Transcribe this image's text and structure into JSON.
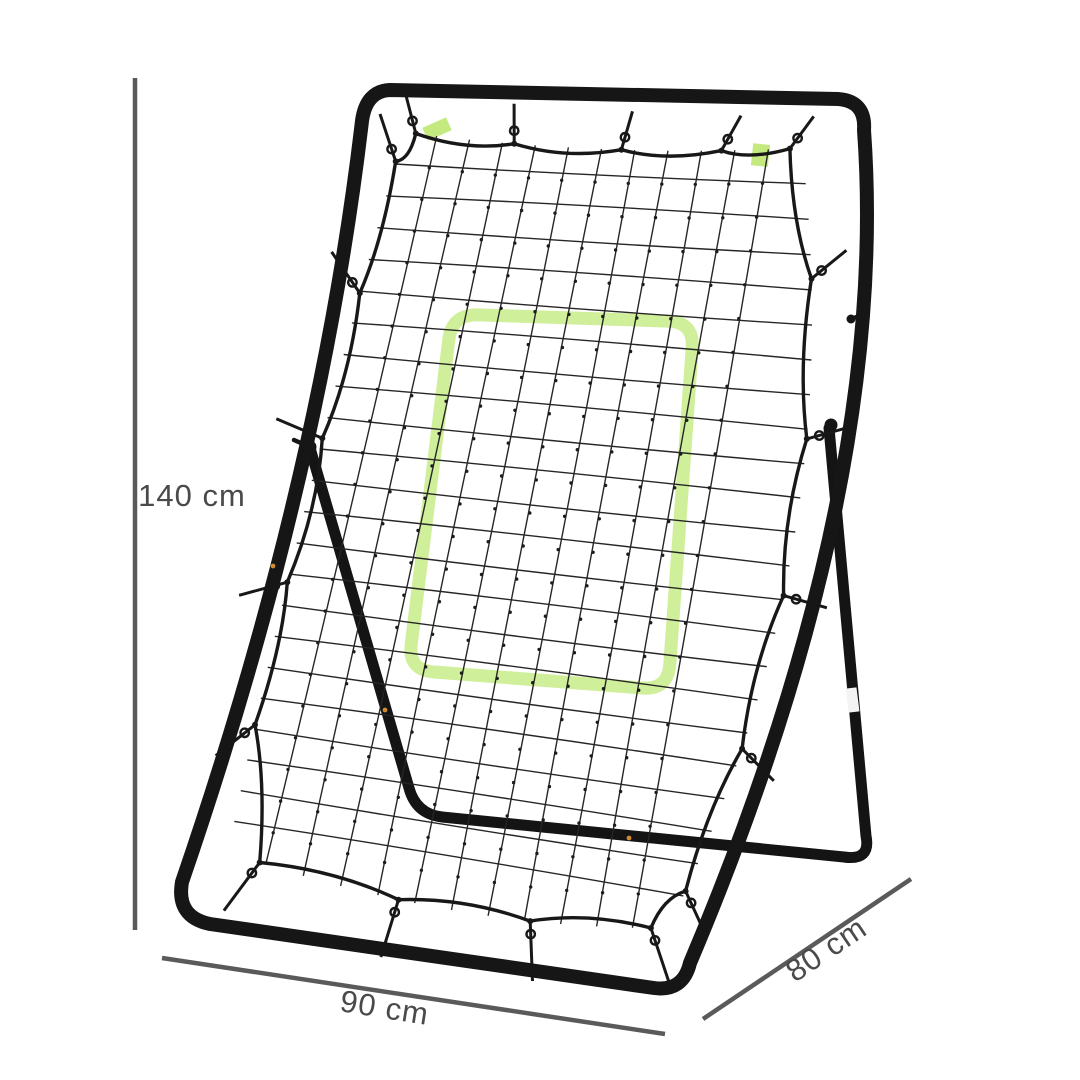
{
  "figure": {
    "type": "product-dimension-diagram",
    "subject": "rebounder net with frame, kickstand and target zone"
  },
  "colors": {
    "background": "#ffffff",
    "frame": "#161616",
    "stand": "#141414",
    "net_cord": "#262626",
    "border_cord": "#181818",
    "knot": "#1c1c1c",
    "target_green": "#cdee96",
    "tag_green": "#c4ea7f",
    "leg_band": "#f4f4f4",
    "accent_dot": "#d18a2f",
    "dimension_line": "#5a5a5a",
    "dimension_text": "#4a4a4a"
  },
  "dimensions": {
    "height_label": "140 cm",
    "width_label": "90 cm",
    "depth_label": "80 cm"
  }
}
